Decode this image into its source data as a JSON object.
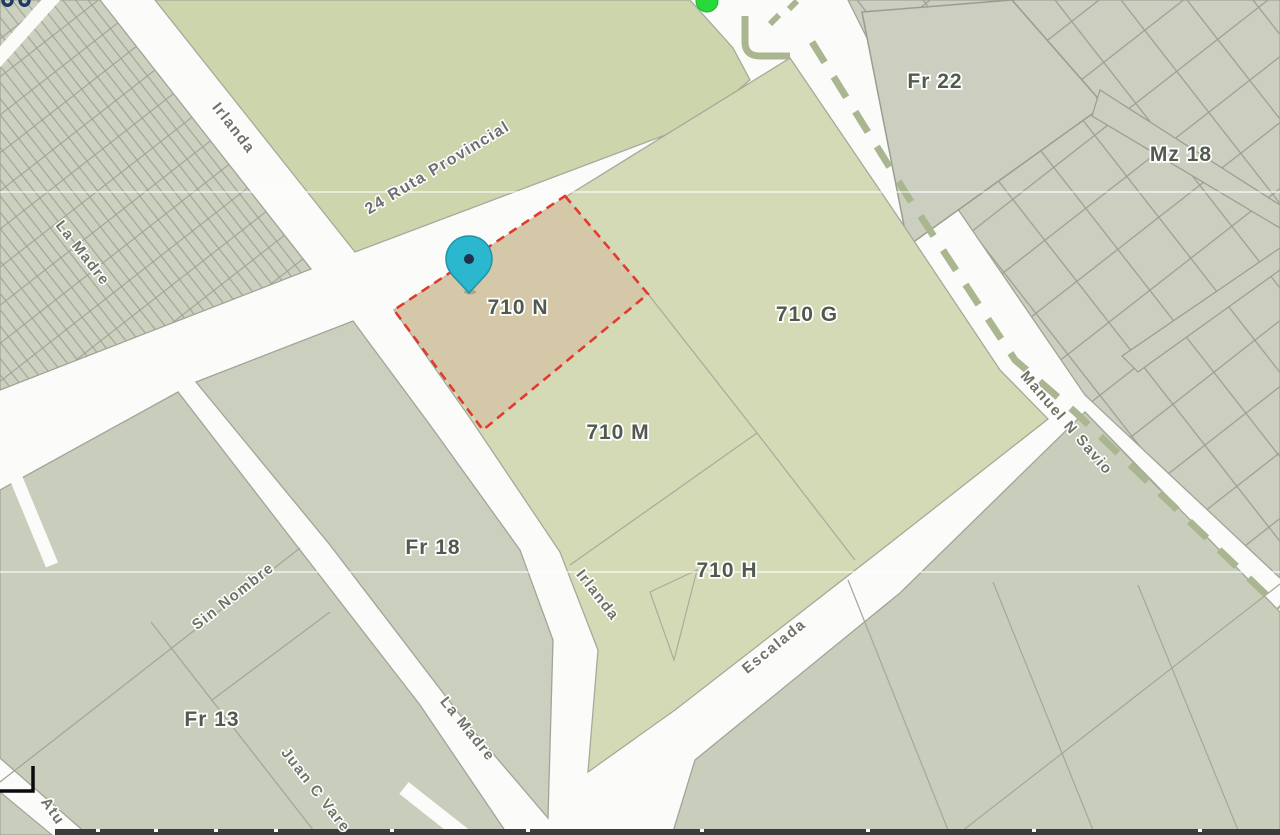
{
  "map": {
    "parcel_labels": [
      {
        "id": "710N",
        "text": "710 N"
      },
      {
        "id": "710G",
        "text": "710 G"
      },
      {
        "id": "710M",
        "text": "710 M"
      },
      {
        "id": "710H",
        "text": "710 H"
      },
      {
        "id": "Fr22",
        "text": "Fr 22"
      },
      {
        "id": "Mz18",
        "text": "Mz 18"
      },
      {
        "id": "Fr18",
        "text": "Fr 18"
      },
      {
        "id": "Fr13",
        "text": "Fr 13"
      }
    ],
    "street_labels": [
      {
        "id": "irlanda-north",
        "text": "Irlanda"
      },
      {
        "id": "la-madre-north",
        "text": "La Madre"
      },
      {
        "id": "ruta-provincial",
        "text": "24 Ruta Provincial"
      },
      {
        "id": "manuel-n-savio",
        "text": "Manuel N Savio"
      },
      {
        "id": "irlanda-south",
        "text": "Irlanda"
      },
      {
        "id": "la-madre-south",
        "text": "La Madre"
      },
      {
        "id": "escalada",
        "text": "Escalada"
      },
      {
        "id": "sin-nombre",
        "text": "Sin Nombre"
      },
      {
        "id": "juan-c-varela",
        "text": "Juan C Vare"
      },
      {
        "id": "atuel",
        "text": "Atu"
      }
    ],
    "highlighted_parcel": {
      "label": "710 N"
    },
    "colors": {
      "road": "#fbfbfa",
      "parcel_gray_green": "#cbd0bf",
      "parcel_light_green": "#ccd5ab",
      "parcel_yellow_green": "#d5dab6",
      "highlight_fill": "#d5c7a9",
      "highlight_border": "#e03b30",
      "route_dash": "#a9b68f",
      "pin": "#2bb7cd",
      "status_dot": "#28d93c"
    }
  }
}
